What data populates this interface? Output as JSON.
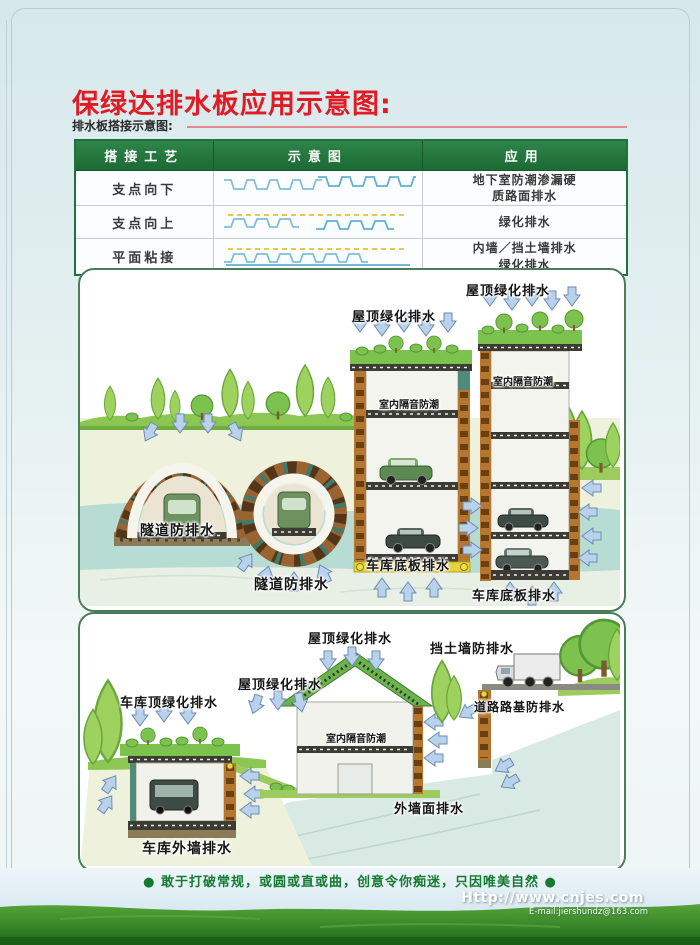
{
  "page": {
    "title": "保绿达排水板应用示意图:",
    "subtitle": "排水板搭接示意图:"
  },
  "table": {
    "headers": [
      "搭接工艺",
      "示意图",
      "应用"
    ],
    "rows": [
      {
        "process": "支点向下",
        "diagram_icon": "drainage-board-points-down",
        "application": "地下室防潮渗漏硬\n质路面排水"
      },
      {
        "process": "支点向上",
        "diagram_icon": "drainage-board-points-up",
        "application": "绿化排水"
      },
      {
        "process": "平面粘接",
        "diagram_icon": "drainage-board-flat-bond",
        "application": "内墙／挡土墙排水\n绿化排水"
      }
    ]
  },
  "panel1": {
    "labels": {
      "roof1": "屋顶绿化排水",
      "roof2": "屋顶绿化排水",
      "indoor1": "室内隔音防潮",
      "indoor2": "室内隔音防潮",
      "tunnel1": "隧道防排水",
      "tunnel2": "隧道防排水",
      "floor1": "车库底板排水",
      "floor2": "车库底板排水"
    }
  },
  "panel2": {
    "labels": {
      "roof_top": "屋顶绿化排水",
      "retaining_wall": "挡土墙防排水",
      "roof_left": "屋顶绿化排水",
      "garage_roof": "车库顶绿化排水",
      "roadbed": "道路路基防排水",
      "indoor": "室内隔音防潮",
      "outer_wall": "外墙面排水",
      "garage_outer_wall": "车库外墙排水"
    }
  },
  "footer": {
    "slogan": "● 敢于打破常规，或圆或直或曲，创意令你痴迷，只因唯美自然 ●",
    "website": "Http://www.cnjes.com",
    "email": "E-mail:jiershundz@163.com"
  },
  "colors": {
    "title_red": "#e01b24",
    "table_header_green": "#1c6a34",
    "panel_border_green": "#4d7b5e",
    "arrow_blue": "#b9d2ec",
    "slogan_green": "#157a31",
    "grass_green": "#3b8d2a"
  }
}
